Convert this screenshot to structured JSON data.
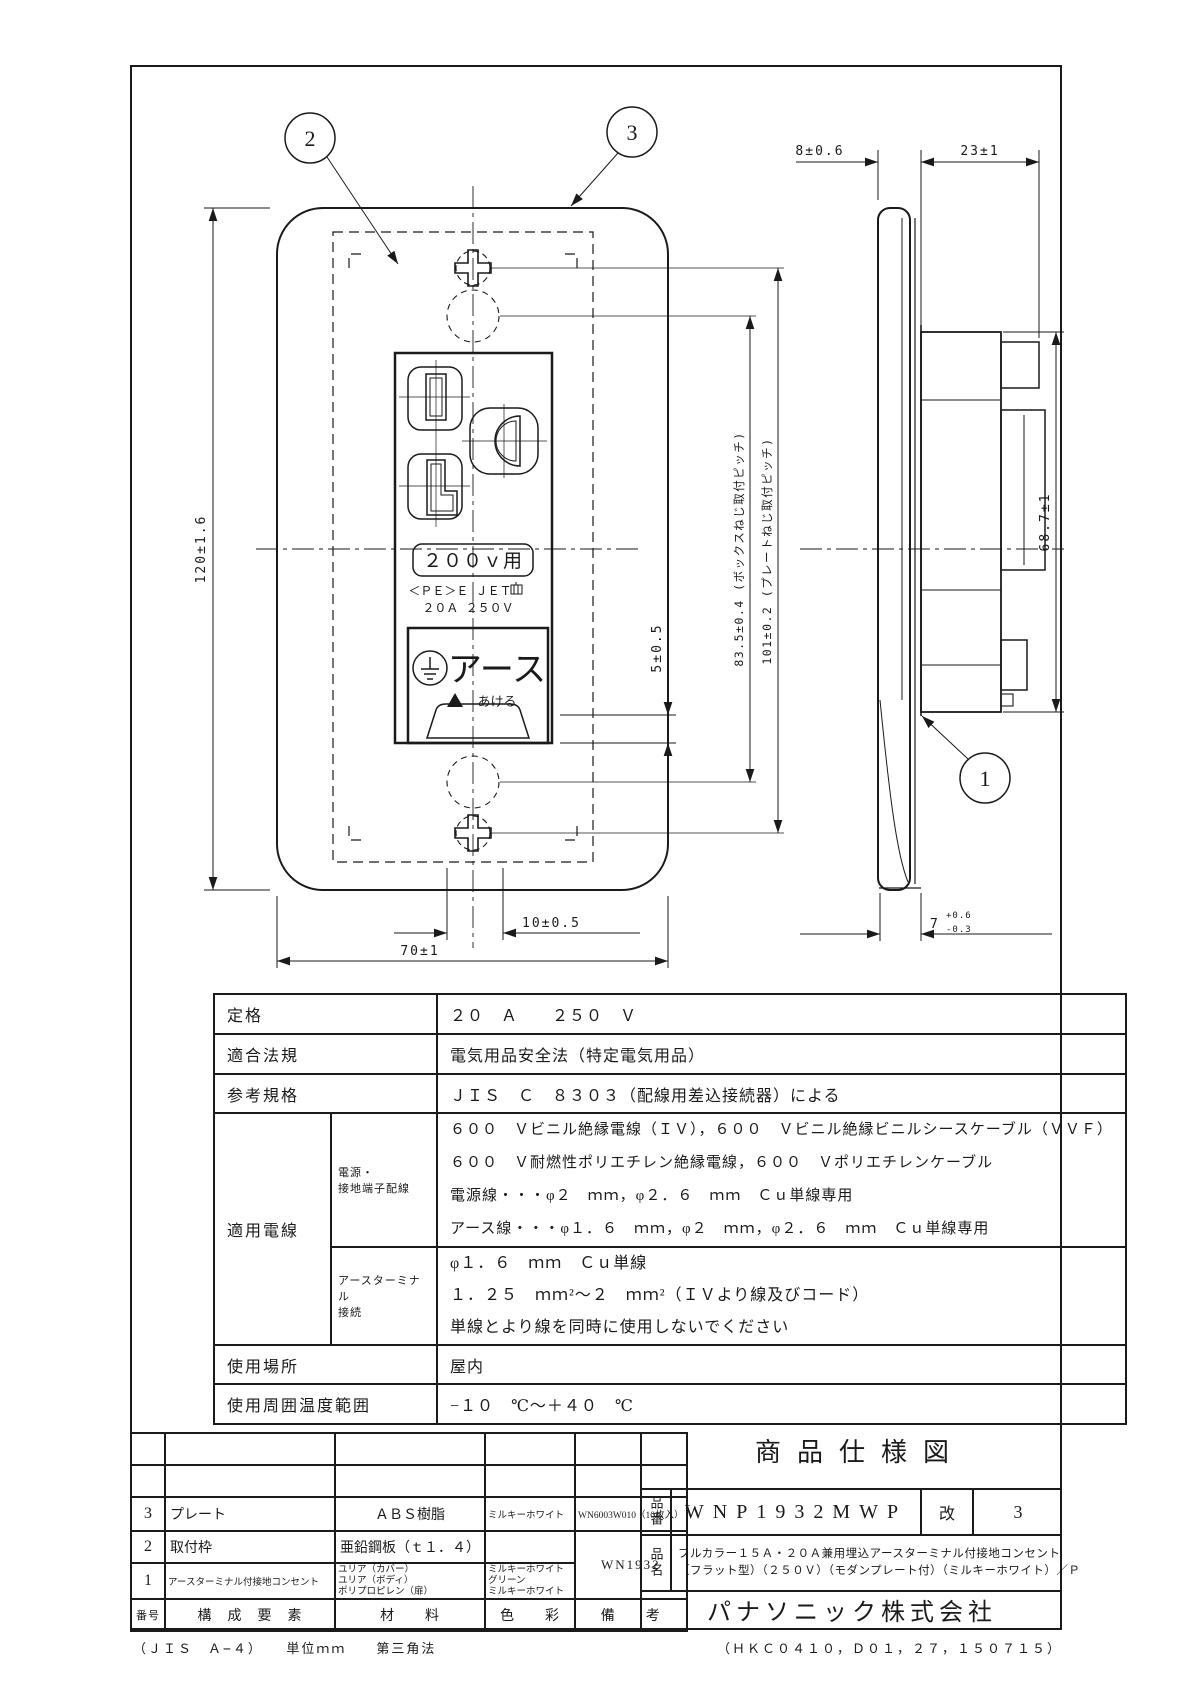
{
  "drawing": {
    "balloons": {
      "receptacle": "1",
      "mount_frame": "2",
      "plate": "3"
    },
    "dims": {
      "plate_depth": "8±0.6",
      "box_depth": "23±1",
      "plate_height": "120±1.6",
      "box_screw_pitch": "83.5±0.4 (ボックスねじ取付ピッチ)",
      "plate_screw_pitch": "101±0.2 (プレートねじ取付ピッチ)",
      "lower_gap": "5±0.5",
      "knockout_width": "10±0.5",
      "plate_width": "70±1",
      "body_height": "68.7±1",
      "flange_nominal": "7",
      "flange_upper": "+0.6",
      "flange_lower": "-0.3"
    },
    "face": {
      "voltage_label": "２００ｖ用",
      "cert_line": "＜ＰＥ＞Ｅ ＪＥＴ",
      "rating_line": "２０Ａ ２５０Ｖ",
      "earth_label": "アース",
      "open_label": "あける"
    }
  },
  "spec": {
    "rows": {
      "rating": {
        "label": "定格",
        "value": "２０　Ａ　　２５０　Ｖ"
      },
      "law": {
        "label": "適合法規",
        "value": "電気用品安全法（特定電気用品）"
      },
      "standard": {
        "label": "参考規格",
        "value": "ＪＩＳ　Ｃ　８３０３（配線用差込接続器）による"
      },
      "wires": {
        "label": "適用電線",
        "power": {
          "label_line1": "電源・",
          "label_line2": "接地端子配線",
          "lines": [
            "６００　Ｖビニル絶縁電線（ＩＶ），６００　Ｖビニル絶縁ビニルシースケーブル（ＶＶＦ）",
            "６００　Ｖ耐燃性ポリエチレン絶縁電線，６００　Ｖポリエチレンケーブル",
            "電源線・・・φ２　ｍｍ，φ２．６　ｍｍ　Ｃｕ単線専用",
            "アース線・・・φ１．６　ｍｍ，φ２　ｍｍ，φ２．６　ｍｍ　Ｃｕ単線専用"
          ]
        },
        "terminal": {
          "label_line1": "アースターミナル",
          "label_line2": "接続",
          "lines": [
            "φ１．６　ｍｍ　Ｃｕ単線",
            "１．２５　ｍｍ²〜２　ｍｍ²（ＩＶより線及びコード）",
            "単線とより線を同時に使用しないでください"
          ]
        }
      },
      "location": {
        "label": "使用場所",
        "value": "屋内"
      },
      "temperature": {
        "label": "使用周囲温度範囲",
        "value": "−１０　℃〜＋４０　℃"
      }
    }
  },
  "parts": {
    "header": {
      "no": "番号",
      "component": "構　成　要　素",
      "material": "材　　料",
      "color": "色　　彩",
      "note": "備　　考"
    },
    "rows": [
      {
        "no": "3",
        "component": "プレート",
        "material": "ＡＢＳ樹脂",
        "color": "ミルキーホワイト",
        "note": "WN6003W010（10枚入）"
      },
      {
        "no": "2",
        "component": "取付枠",
        "material": "亜鉛鋼板（ｔ１．４）"
      },
      {
        "no": "1",
        "component": "アースターミナル付接地コンセント",
        "material_lines": [
          "ユリア（カバー）",
          "ユリア（ボディ）",
          "ポリプロピレン（扉）"
        ],
        "color_lines": [
          "ミルキーホワイト",
          "グリーン",
          "ミルキーホワイト"
        ]
      }
    ],
    "merged_note": "WN1932"
  },
  "title_block": {
    "doc_title": "商品仕様図",
    "part_no_label": "品番",
    "part_no": "WNP1932MWP",
    "rev_label": "改",
    "rev": "3",
    "name_label": "品名",
    "name_line1": "フルカラー１５Ａ・２０Ａ兼用埋込アースターミナル付接地コンセント",
    "name_line2": "（フラット型）（２５０Ｖ）（モダンプレート付）（ミルキーホワイト）／Ｐ",
    "company": "パナソニック株式会社"
  },
  "footer": {
    "left": "（ＪＩＳ　Ａ−４）　　単位ｍｍ　　第三角法",
    "right": "（ＨＫＣ０４１０，Ｄ０１，２７，１５０７１５）"
  },
  "colors": {
    "line": "#1a1a1a",
    "bg": "#ffffff"
  }
}
